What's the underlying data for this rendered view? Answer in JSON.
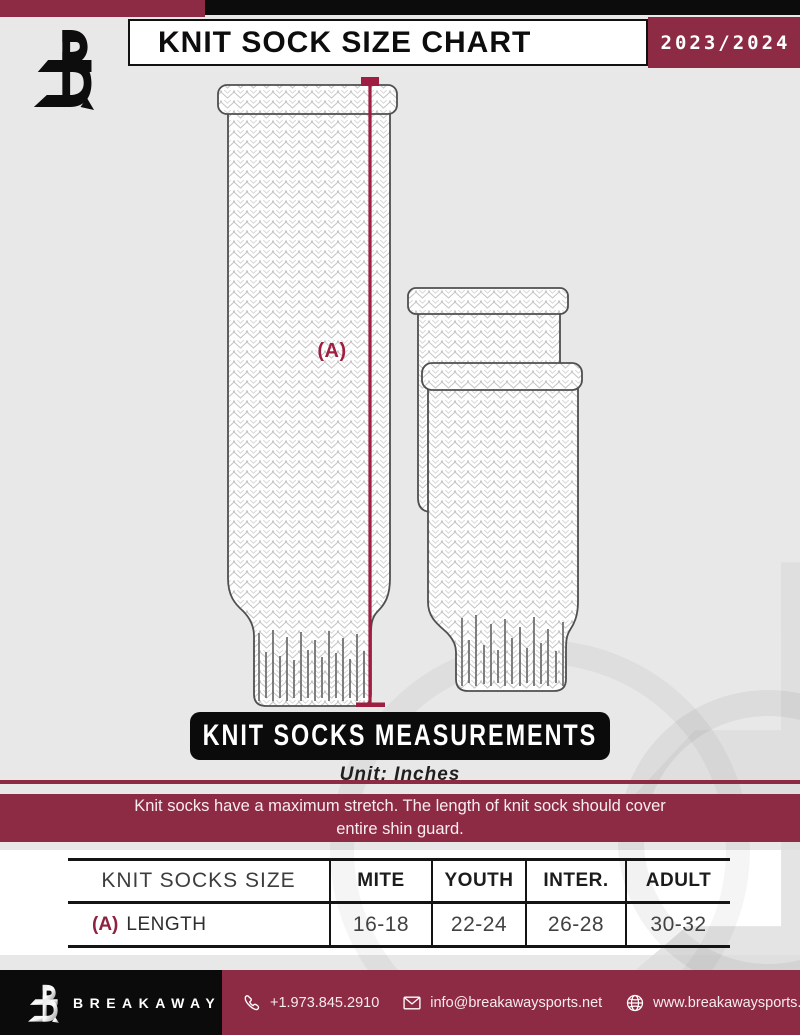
{
  "header": {
    "title": "KNIT SOCK SIZE CHART",
    "season": "2023/2024"
  },
  "diagram": {
    "label_a": "(A)"
  },
  "measurements": {
    "banner_title": "KNIT SOCKS MEASUREMENTS",
    "unit": "Unit: Inches",
    "notice_line1": "Knit socks have a maximum stretch. The length of knit sock should cover",
    "notice_line2": "entire shin guard."
  },
  "table": {
    "row_header": "KNIT SOCKS SIZE",
    "columns": [
      "MITE",
      "YOUTH",
      "INTER.",
      "ADULT"
    ],
    "row": {
      "marker": "(A)",
      "label": "LENGTH",
      "values": [
        "16-18",
        "22-24",
        "26-28",
        "30-32"
      ]
    }
  },
  "footer": {
    "brand": "BREAKAWAY",
    "phone": "+1.973.845.2910",
    "email": "info@breakawaysports.net",
    "website": "www.breakawaysports.net"
  },
  "colors": {
    "maroon": "#8e2b44",
    "accent_line": "#9e1f41",
    "black": "#0c0c0c",
    "background": "#e8e8e8"
  }
}
